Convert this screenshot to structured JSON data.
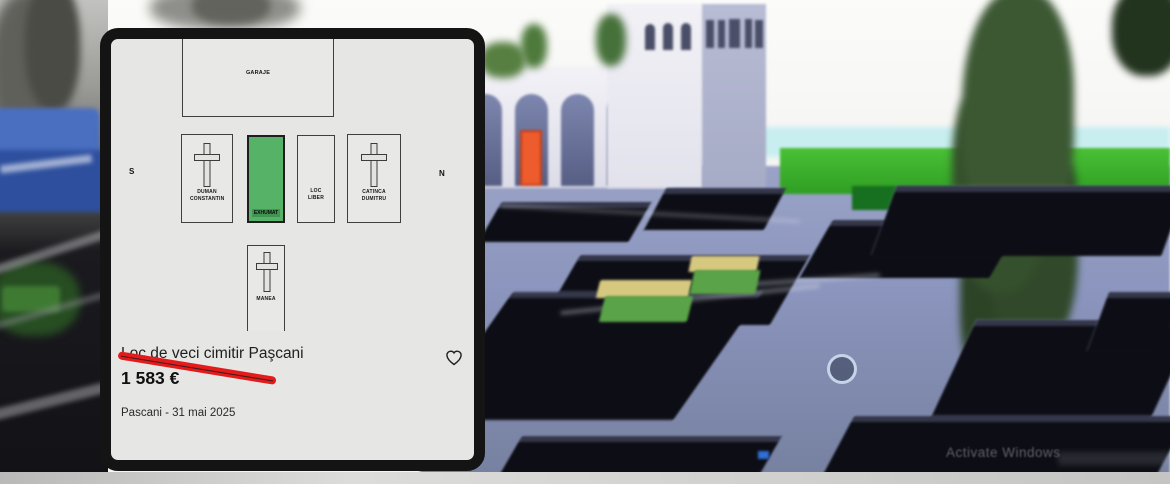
{
  "listing_card": {
    "map": {
      "garage_label": "GARAJE",
      "compass_south": "S",
      "compass_north": "N",
      "plots": [
        {
          "label": "DUMAN CONSTANTIN",
          "cross": true,
          "state": "occupied"
        },
        {
          "label": "EXHUMAT",
          "cross": false,
          "state": "for-sale-highlighted",
          "highlight_color": "#56b266"
        },
        {
          "label": "LOC LIBER",
          "cross": false,
          "state": "free"
        },
        {
          "label": "CATINCA DUMITRU",
          "cross": true,
          "state": "occupied"
        },
        {
          "label": "MANEA",
          "cross": true,
          "state": "occupied"
        }
      ]
    },
    "title": "Loc de veci cimitir Paşcani",
    "price": "1 583 €",
    "location_date": "Pascani - 31 mai 2025",
    "favorite_icon": "heart-outline",
    "annotation_color": "#e41b1b"
  },
  "background": {
    "watermark": "Activate Windows",
    "colors": {
      "plaza": "#8b95bd",
      "tomb_slab": "#0d0e15",
      "lawn_green": "#3aa92c",
      "door_orange": "#ee5b2c",
      "highlight_plot_green": "#56b266"
    }
  }
}
